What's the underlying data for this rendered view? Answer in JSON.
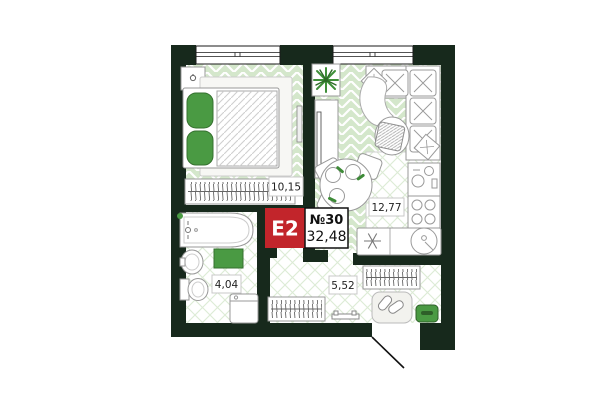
{
  "unit": {
    "type_label": "E2",
    "number": "№30",
    "total_area": "32,48"
  },
  "rooms": {
    "bedroom": {
      "area": "10,15"
    },
    "kitchen_living": {
      "area": "12,77"
    },
    "bathroom": {
      "area": "4,04"
    },
    "hallway": {
      "area": "5,52"
    }
  },
  "colors": {
    "wall": "#17291c",
    "accent_green": "#4a9a43",
    "accent_green_dark": "#2e6b28",
    "floor_green": "#d4e7cb",
    "badge_red": "#c2252b"
  }
}
